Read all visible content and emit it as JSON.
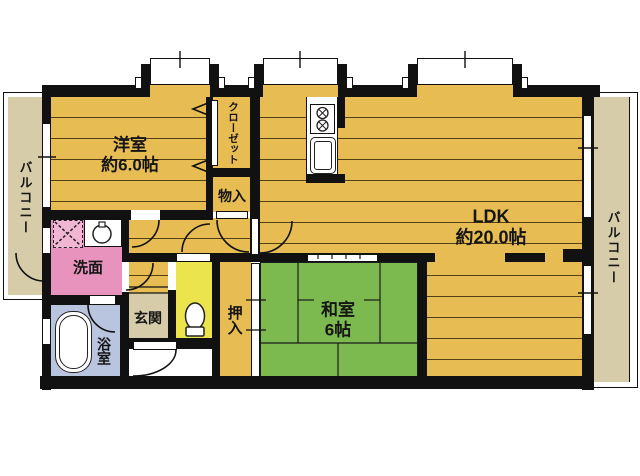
{
  "plan": {
    "title": "apartment-floor-plan",
    "rooms": {
      "yoshitsu": {
        "name": "洋室",
        "size": "約6.0帖"
      },
      "ldk": {
        "name": "LDK",
        "size": "約20.0帖"
      },
      "washitsu": {
        "name": "和室",
        "size": "6帖"
      },
      "closet": {
        "label": "クローゼット"
      },
      "monoire": {
        "label": "物入"
      },
      "oshiire": {
        "label": "押入"
      },
      "genkan": {
        "label": "玄関"
      },
      "senmen": {
        "label": "洗面"
      },
      "bathroom": {
        "label": "浴室"
      },
      "balcony_left": {
        "label": "バルコニー"
      },
      "balcony_right": {
        "label": "バルコニー"
      }
    },
    "fixtures": [
      "washing-machine-pan",
      "washbasin",
      "bathtub",
      "toilet",
      "kitchen-stove",
      "kitchen-sink",
      "kitchen-counter"
    ],
    "colors": {
      "flooring": "#e7bd53",
      "tatami_green": "#7cb94f",
      "washroom_pink": "#e793bd",
      "bath_blue": "#b9c4de",
      "toilet_yellow": "#ece44d",
      "balcony_tan": "#d6cca9",
      "wall_black": "#111111",
      "background": "#ffffff"
    }
  }
}
